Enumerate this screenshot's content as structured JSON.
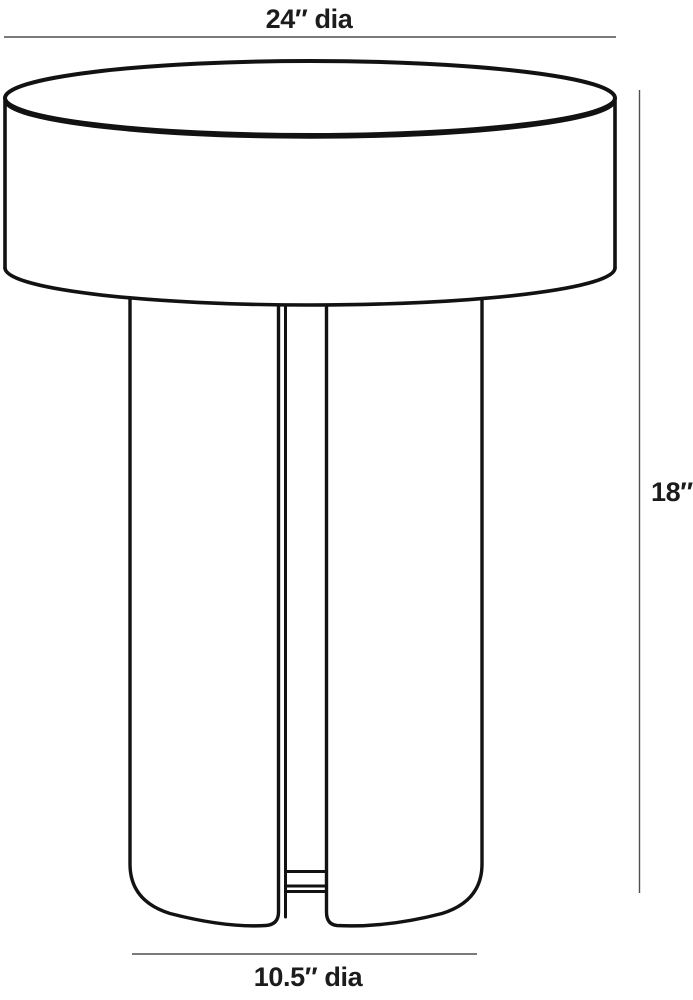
{
  "diagram": {
    "type": "furniture-dimension-drawing",
    "subject": "round side table with slotted cylindrical pedestal base",
    "background_color": "#ffffff",
    "outline_color": "#121212",
    "dimension_line_color": "#4f4f4f",
    "label_color": "#1c1c1c",
    "dimensions": {
      "top_diameter": {
        "label": "24″ dia",
        "value": 24,
        "unit": "inches",
        "applies_to": "table top diameter"
      },
      "height": {
        "label": "18″",
        "value": 18,
        "unit": "inches",
        "applies_to": "overall table height"
      },
      "base_diameter": {
        "label": "10.5″ dia",
        "value": 10.5,
        "unit": "inches",
        "applies_to": "pedestal base diameter"
      }
    }
  }
}
